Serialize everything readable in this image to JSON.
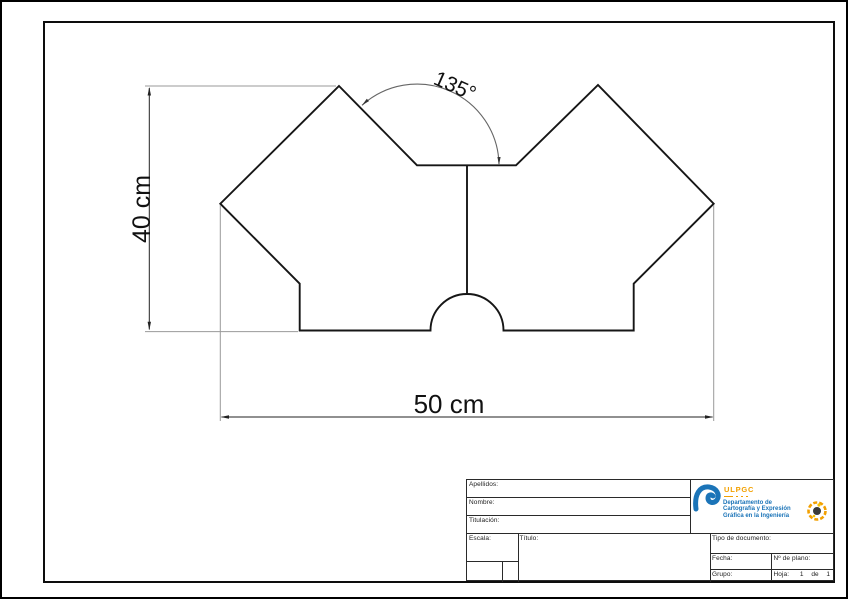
{
  "drawing": {
    "dim_height": "40 cm",
    "dim_width": "50 cm",
    "dim_angle": "135°"
  },
  "title_block": {
    "apellidos_label": "Apellidos:",
    "nombre_label": "Nombre:",
    "titulacion_label": "Titulación:",
    "escala_label": "Escala:",
    "titulo_label": "Título:",
    "tipo_documento_label": "Tipo de documento:",
    "fecha_label": "Fecha:",
    "num_plano_label": "Nº de plano:",
    "grupo_label": "Grupo:",
    "hoja_label": "Hoja:",
    "hoja_value": "1 de 1",
    "paper_size": "A3"
  },
  "logo": {
    "acronym": "ULPGC",
    "department_lines": [
      "Departamento de",
      "Cartografía y Expresión",
      "Gráfica en la Ingeniería"
    ]
  },
  "colors": {
    "ulpgc_blue": "#1B74B8",
    "ulpgc_orange": "#F2A001",
    "outline": "#161616",
    "extension_line": "#9a9a9a"
  }
}
